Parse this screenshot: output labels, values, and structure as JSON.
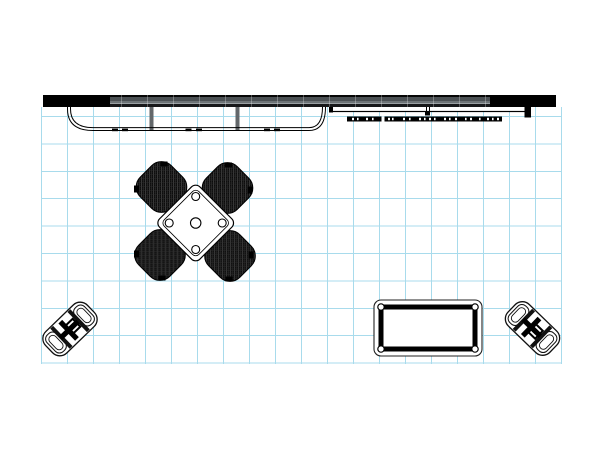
{
  "meta": {
    "title": "Trade Show Booth Floor Plan - Top View",
    "description": "CAD top-view line drawing of a 20ft inline exhibit booth on a light blue grid: long backwall with reception counter and shelf, round conference table with four wicker chairs, low display table and two folding stools",
    "grid": {
      "color": "#a8dbec",
      "cell_px": 26,
      "columns": 20,
      "rows": 9
    }
  },
  "colors": {
    "background": "#ffffff",
    "grid_line": "#a8dbec",
    "wall_black": "#000000",
    "wall_gray": "#4b5053",
    "line_work": "#000000",
    "post_gray": "#63676a"
  },
  "objects": {
    "backwall": "backwall-extrusion-20ft",
    "backwall_left_panel": "black-end-panel-left",
    "backwall_right_panel": "black-end-panel-right",
    "counter": "reception-counter-with-radius-ends",
    "counter_posts": "support-posts",
    "shelf": "wall-mounted-shelf",
    "light_track": "accent-light-track",
    "conference_table": "square-conference-table-rotated",
    "chairs": [
      "wicker-chair-nw",
      "wicker-chair-ne",
      "wicker-chair-sw",
      "wicker-chair-se"
    ],
    "stool_left": "folding-stool-left",
    "stool_right": "folding-stool-right",
    "side_table": "rectangular-display-table"
  }
}
